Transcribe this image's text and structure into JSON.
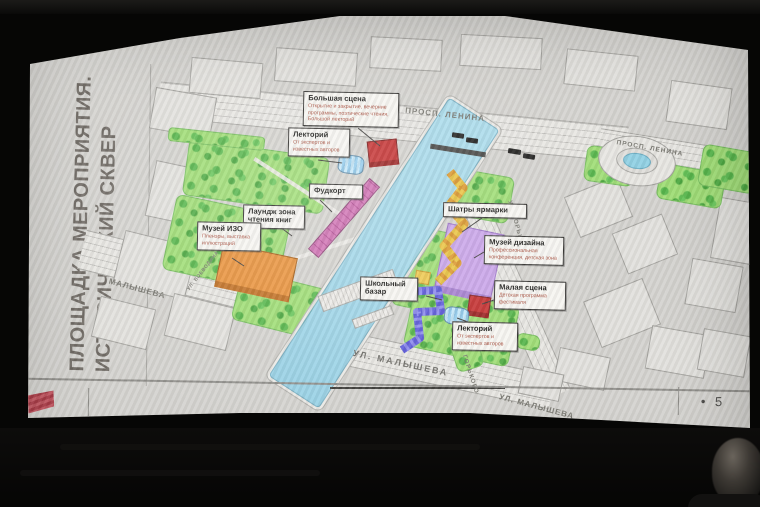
{
  "slide": {
    "title_line1": "ПЛОЩАДКА МЕРОПРИЯТИЯ.",
    "title_line2": "ИСТОРИЧЕСКИЙ СКВЕР",
    "footer": {
      "page_marker": "•  5"
    }
  },
  "map": {
    "street_labels": [
      {
        "text": "ПРОСП. ЛЕНИНА"
      },
      {
        "text": "ПРОСП. ЛЕНИНА"
      },
      {
        "text": "МАЛЫШЕВА"
      },
      {
        "text": "УЛ. МАЛЫШЕВА"
      },
      {
        "text": "УЛ. ГОРЬКОГО"
      },
      {
        "text": "УЛ. ГОРЬКОГО"
      },
      {
        "text": "УЛ. ВОЕВОДИНА"
      },
      {
        "text": "УЛ. МАЛЫШЕВА"
      }
    ],
    "callouts": [
      {
        "id": "big-stage",
        "title": "Большая сцена",
        "subtitle": "Открытие и закрытие, вечерние программы, поэтические чтения, Большой лекторий"
      },
      {
        "id": "lectory-left",
        "title": "Лекторий",
        "subtitle": "От экспертов и известных авторов"
      },
      {
        "id": "foodcourt",
        "title": "Фудкорт"
      },
      {
        "id": "lounge",
        "title": "Лаундж зона чтения книг"
      },
      {
        "id": "museum-izo",
        "title": "Музей ИЗО",
        "subtitle": "Пленэры, выставка иллюстраций"
      },
      {
        "id": "fair-tents",
        "title": "Шатры ярмарки"
      },
      {
        "id": "museum-design",
        "title": "Музей дизайна",
        "subtitle": "Профессиональная конференция, детская зона"
      },
      {
        "id": "school-bazaar",
        "title": "Школьный базар"
      },
      {
        "id": "small-stage",
        "title": "Малая сцена",
        "subtitle": "Детская программа фестиваля"
      },
      {
        "id": "lectory-bottom",
        "title": "Лекторий",
        "subtitle": "От экспертов и известных авторов"
      }
    ],
    "palette": {
      "canal": "#9bd2e6",
      "park": "#9edd74",
      "museum_izo": "#e8913a",
      "museum_design": "#c9a4e9",
      "stages": "#c43030",
      "foodcourt": "#c05fa8",
      "fair_tents": "#e9c23f",
      "school_bazaar": "#5a57d8",
      "logo_red": "#b04a56"
    }
  }
}
